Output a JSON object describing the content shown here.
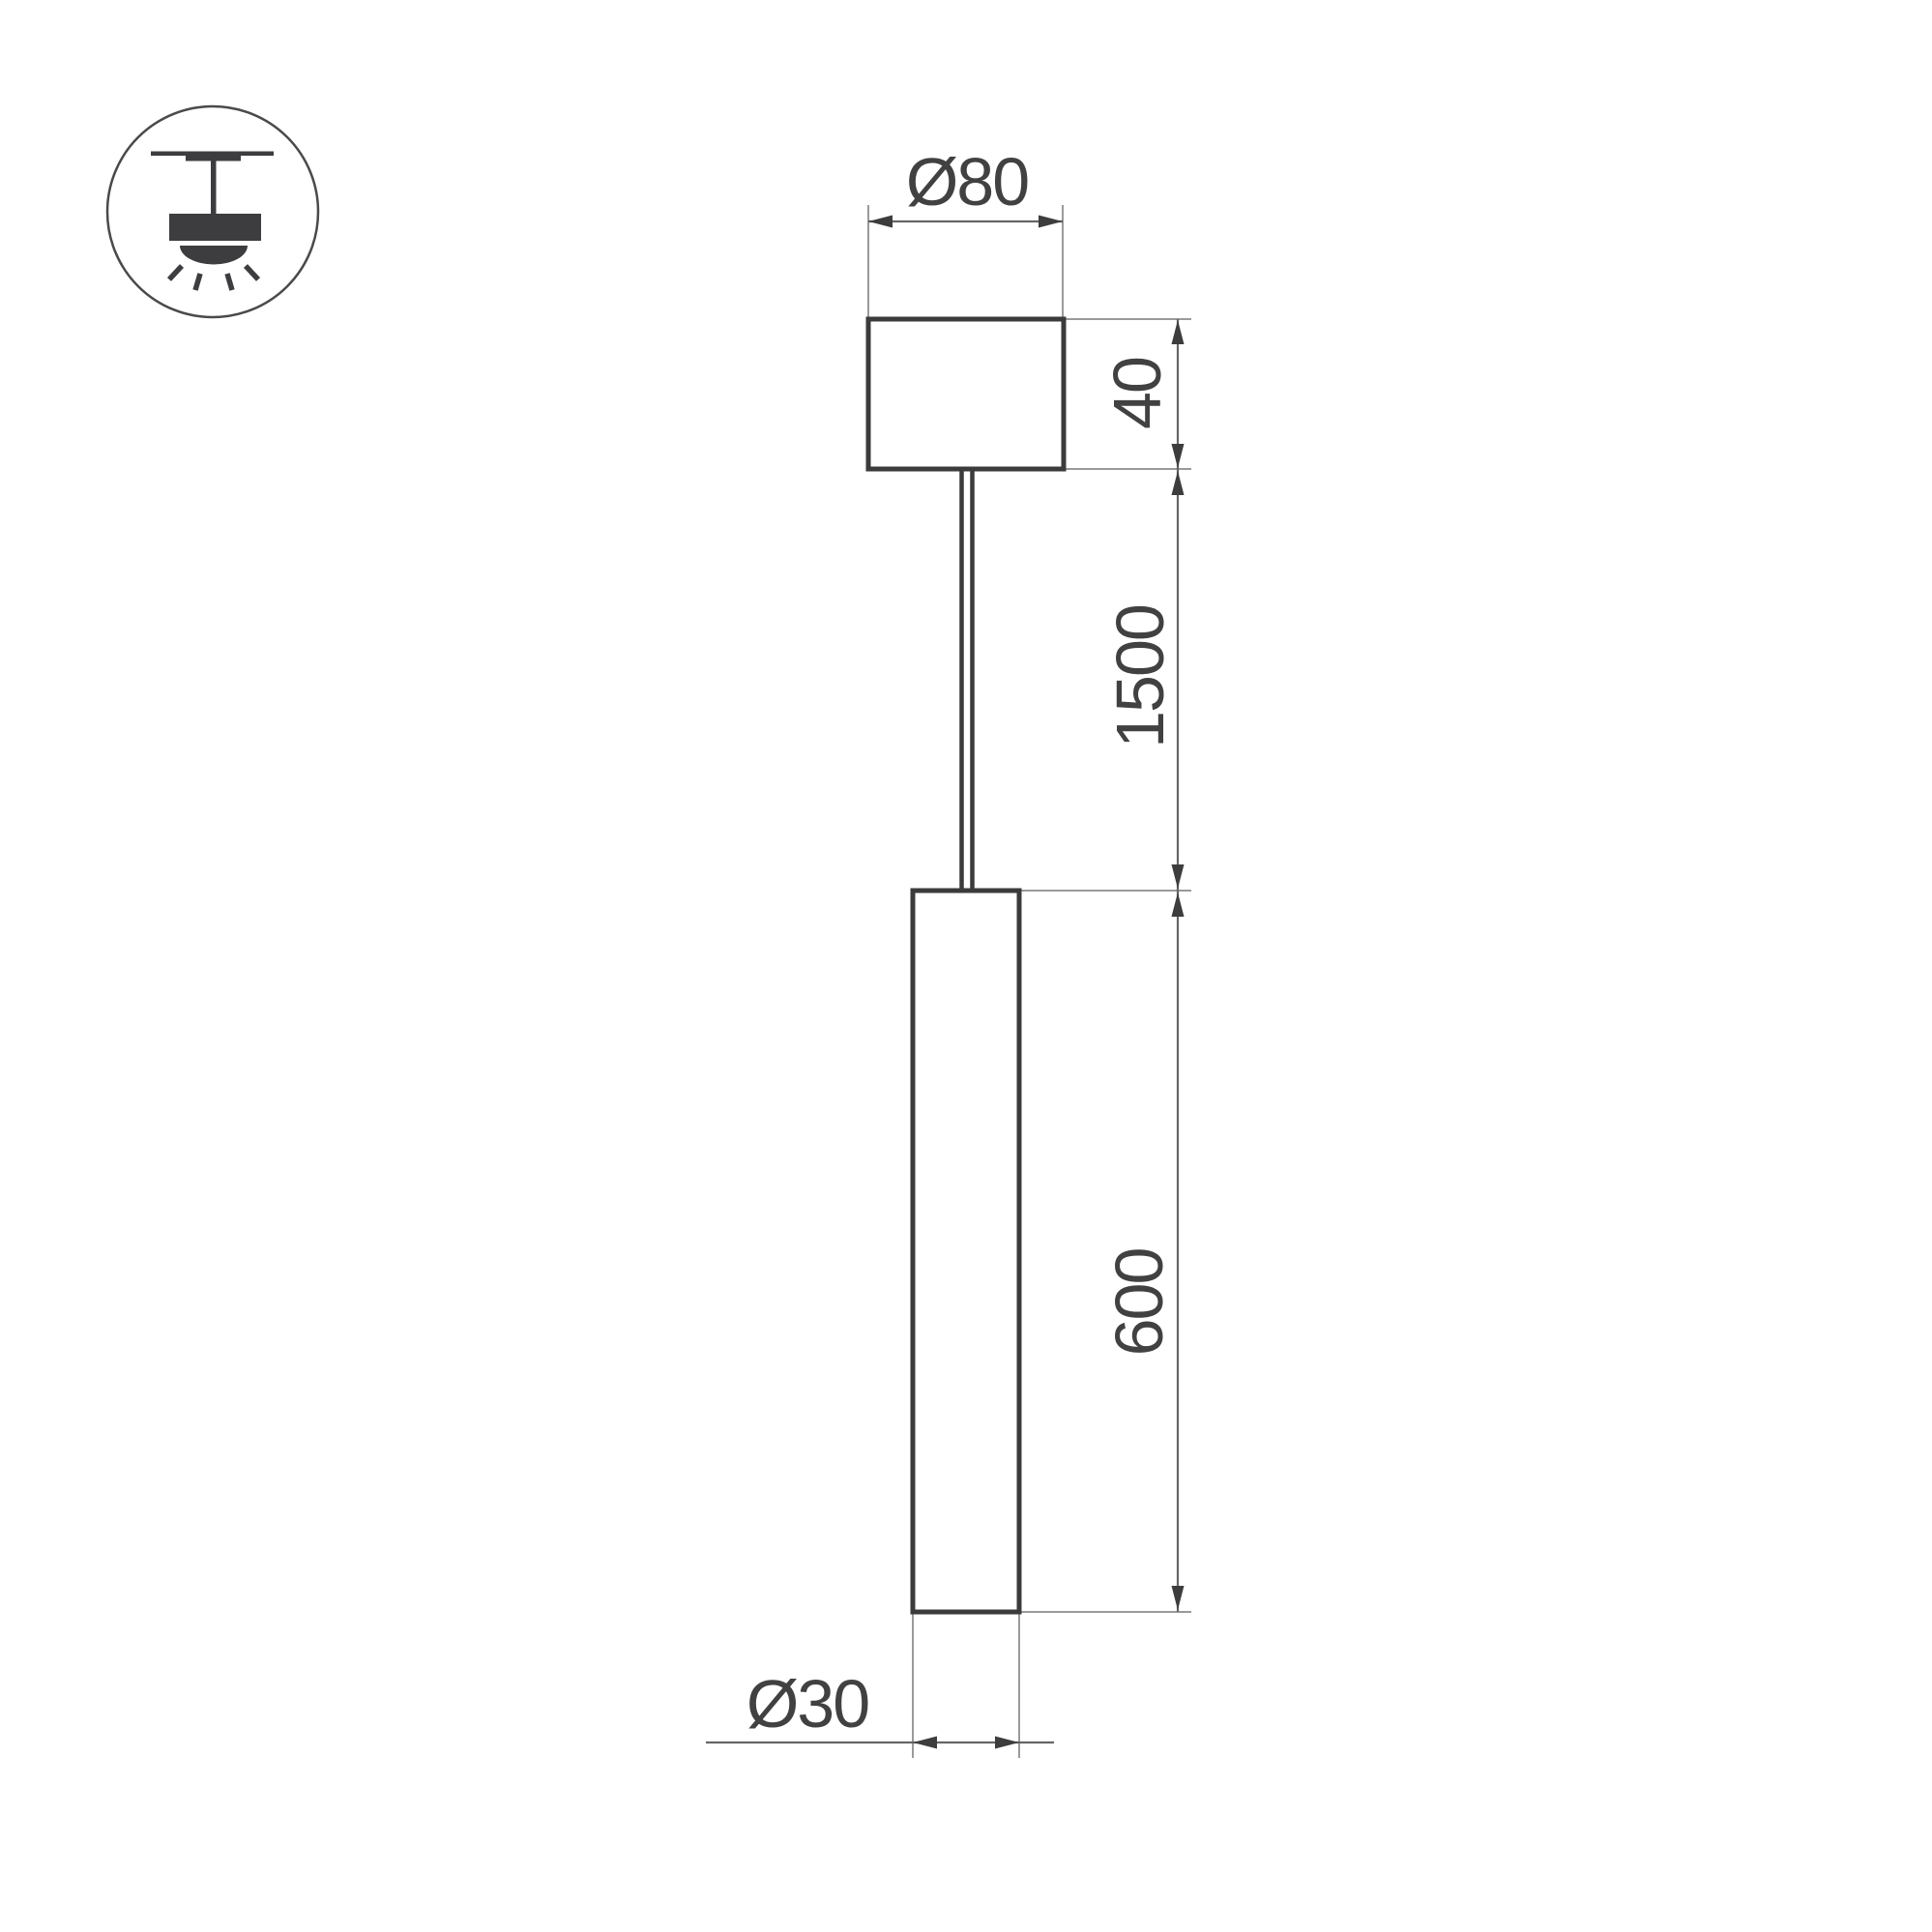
{
  "title": "Pendant luminaire dimensional drawing",
  "icon": {
    "name": "pendant-ceiling-mount-icon",
    "meaning": "surface ceiling mounted pendant light"
  },
  "labels": {
    "canopy_diameter": "Ø80",
    "canopy_height": "40",
    "suspension_length": "1500",
    "fixture_length": "600",
    "fixture_diameter": "Ø30"
  },
  "colors": {
    "background": "#ffffff",
    "object_outline": "#3b3b3b",
    "dimension_line": "#666666",
    "extension_line": "#9a9a9a",
    "arrowhead": "#3d3d3d",
    "text": "#414141",
    "icon_fill": "#3d3d40"
  }
}
